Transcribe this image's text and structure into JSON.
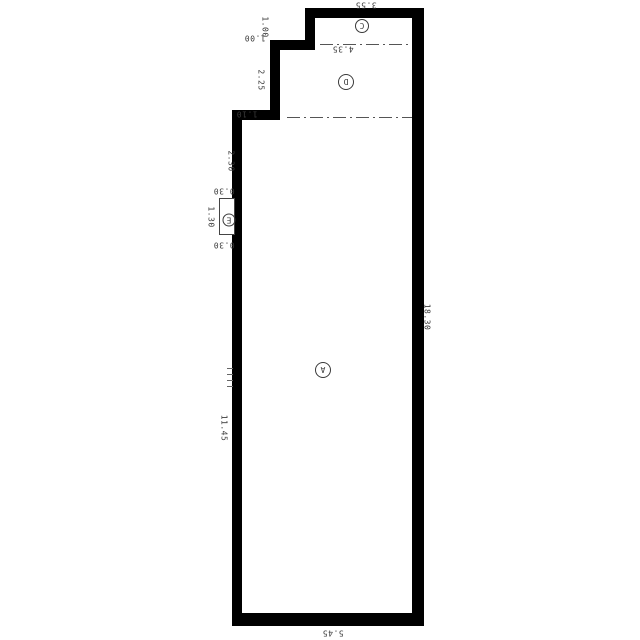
{
  "plan": {
    "dims": {
      "top_width": "3.55",
      "step1_height": "1.00",
      "step1_width": "1.00",
      "step2_height": "2.25",
      "step2_width": "1.10",
      "left_upper": "2.30",
      "niche_gap_top": "0.30",
      "niche_length": "1.30",
      "niche_gap_bottom": "0.30",
      "left_lower": "11.45",
      "right_side": "18.30",
      "bottom_width": "5.45",
      "middle_width": "4.35"
    },
    "areas": {
      "top_area": "C",
      "middle_area": "D",
      "main_area": "A",
      "niche_area": "E"
    },
    "colors": {
      "wall": "#000000",
      "dim_text": "#3a3a3a",
      "thin_line": "#555555",
      "background": "#ffffff"
    }
  }
}
